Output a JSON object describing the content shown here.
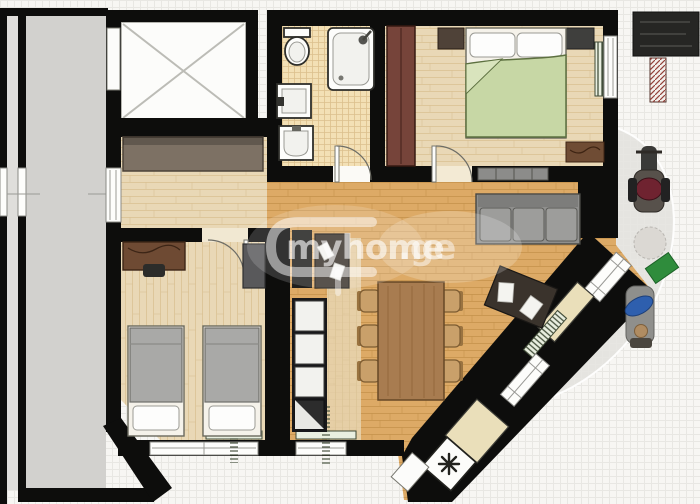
{
  "watermark": {
    "brand": "myhome",
    "suffix": ".ge"
  },
  "icons": {
    "appliance_symbol": "✳"
  },
  "colors": {
    "page_bg": "#f7f6f3",
    "grid_line": "#e8e7e3",
    "patio": "#e5e4e0",
    "corridor": "#d2d1ce",
    "corridor_outer": "#dfdedb",
    "wall": "#0d0d0c",
    "wood_amber": "#ddaa66",
    "wood_amber_line": "#c6924c",
    "wood_pale": "#e9d8b6",
    "wood_pale_line": "#d9c293",
    "tile": "#f3e0b5",
    "tile_line": "#dcc08d",
    "bed_green": "#c7d7a5",
    "bed_green_edge": "#5d7040",
    "blanket_gray": "#a9a9a7",
    "sofa_gray": "#8f8f8d",
    "table_wood": "#a87c50",
    "chair_tan": "#c9a06a",
    "wardrobe_red": "#76443a",
    "wardrobe_taupe": "#7d7164",
    "cream": "#eadfba",
    "mat_green": "#2f8c3c",
    "moto_red": "#6f2330",
    "cyclist_blue": "#2e5fae"
  }
}
